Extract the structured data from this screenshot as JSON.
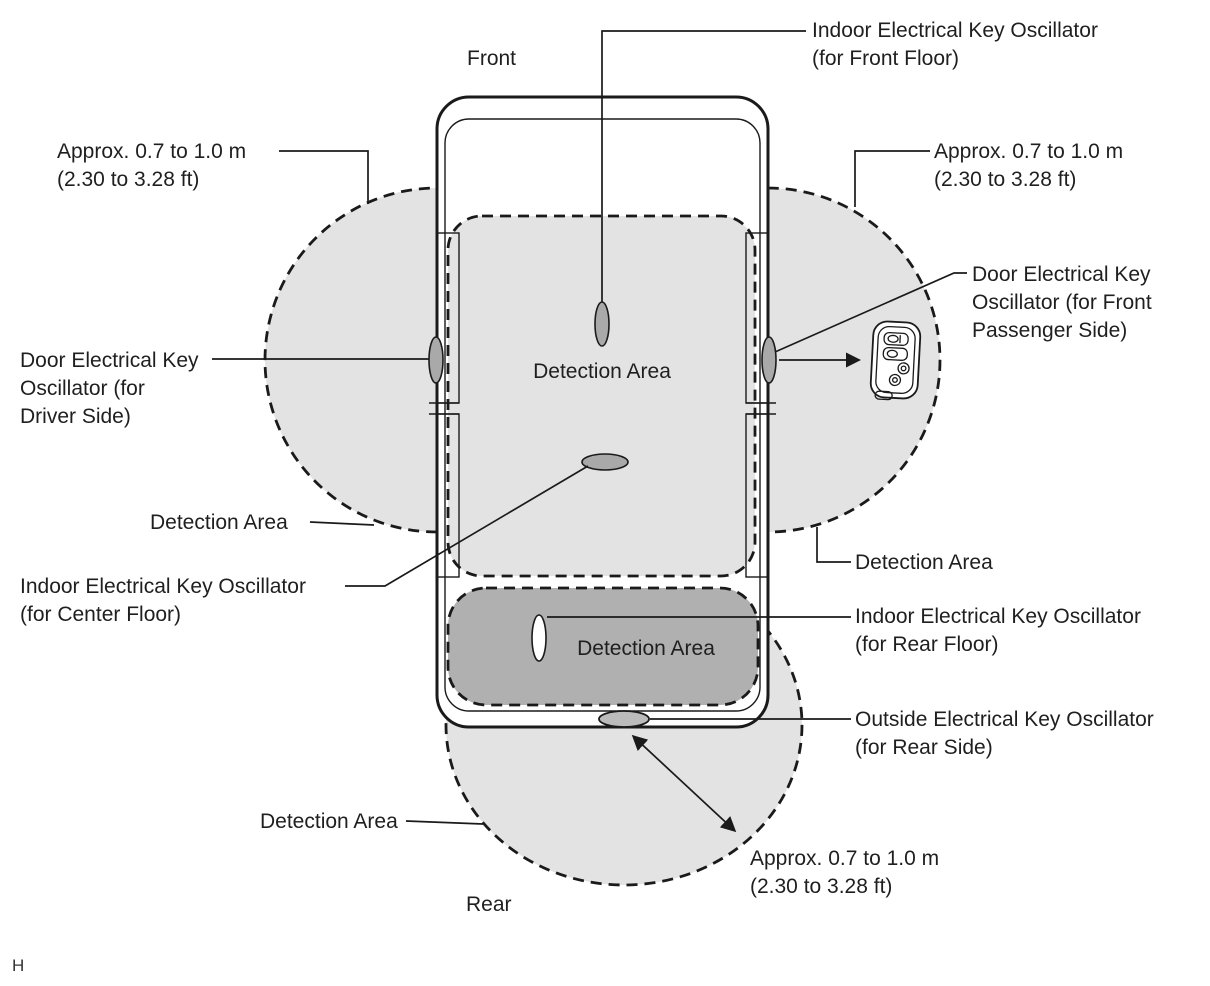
{
  "diagram": {
    "title_context": "Smart key detection areas (vehicle top view)",
    "orientation": {
      "front": "Front",
      "rear": "Rear"
    },
    "page_marker": "H",
    "colors": {
      "background": "#ffffff",
      "outline": "#1a1a1a",
      "area_fill": "#e3e3e3",
      "rear_area_fill": "#b0b0b0",
      "oscillator_fill": "#a9a9a9"
    },
    "labels": {
      "detection_area": "Detection Area",
      "approx_distance": {
        "l1": "Approx. 0.7 to 1.0 m",
        "l2": "(2.30 to 3.28 ft)"
      },
      "front_floor": {
        "l1": "Indoor Electrical Key Oscillator",
        "l2": "(for Front Floor)"
      },
      "center_floor": {
        "l1": "Indoor Electrical Key Oscillator",
        "l2": "(for Center Floor)"
      },
      "rear_floor": {
        "l1": "Indoor Electrical Key Oscillator",
        "l2": "(for Rear Floor)"
      },
      "outside_rear": {
        "l1": "Outside Electrical Key Oscillator",
        "l2": "(for Rear Side)"
      },
      "driver_door": {
        "l1": "Door Electrical Key",
        "l2": "Oscillator (for",
        "l3": "Driver Side)"
      },
      "passenger_door": {
        "l1": "Door Electrical Key",
        "l2": "Oscillator (for Front",
        "l3": "Passenger Side)"
      }
    }
  }
}
